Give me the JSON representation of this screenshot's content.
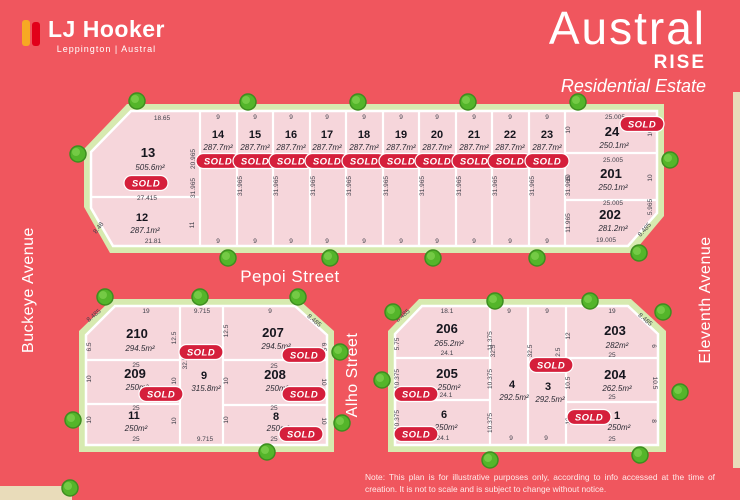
{
  "brand": {
    "name": "LJ Hooker",
    "location": "Leppington | Austral"
  },
  "title": {
    "main": "Austral",
    "sub": "RISE",
    "tagline": "Residential Estate"
  },
  "streets": {
    "buckeye": "Buckeye Avenue",
    "eleventh": "Eleventh Avenue",
    "pepoi": "Pepoi Street",
    "alho": "Alho Street"
  },
  "note": {
    "line1": "Note: This plan is for illustrative purposes only, according to info accessed at the time of",
    "line2": "creation. It is not to scale and is subject to change without notice."
  },
  "sold_label": "SOLD",
  "colors": {
    "background": "#f0565e",
    "lot_fill": "#f6d6db",
    "border_green": "#d7eab0",
    "tree_green": "#54b52a",
    "sold_red": "#d51f3b",
    "logo_yellow": "#f7a823",
    "logo_red": "#e2001a"
  },
  "lots": {
    "13": {
      "num": "13",
      "area": "505.6m²",
      "sold": true
    },
    "12": {
      "num": "12",
      "area": "287.1m²",
      "sold": false
    },
    "14": {
      "num": "14",
      "area": "287.7m²",
      "sold": true
    },
    "15": {
      "num": "15",
      "area": "287.7m²",
      "sold": true
    },
    "16": {
      "num": "16",
      "area": "287.7m²",
      "sold": true
    },
    "17": {
      "num": "17",
      "area": "287.7m²",
      "sold": true
    },
    "18": {
      "num": "18",
      "area": "287.7m²",
      "sold": true
    },
    "19": {
      "num": "19",
      "area": "287.7m²",
      "sold": true
    },
    "20": {
      "num": "20",
      "area": "287.7m²",
      "sold": true
    },
    "21": {
      "num": "21",
      "area": "287.7m²",
      "sold": true
    },
    "22": {
      "num": "22",
      "area": "287.7m²",
      "sold": true
    },
    "23": {
      "num": "23",
      "area": "287.7m²",
      "sold": true
    },
    "24": {
      "num": "24",
      "area": "250.1m²",
      "sold": true
    },
    "201": {
      "num": "201",
      "area": "250.1m²",
      "sold": false
    },
    "202": {
      "num": "202",
      "area": "281.2m²",
      "sold": false
    },
    "210": {
      "num": "210",
      "area": "294.5m²",
      "sold": false
    },
    "209": {
      "num": "209",
      "area": "250m²",
      "sold": true
    },
    "11": {
      "num": "11",
      "area": "250m²",
      "sold": false
    },
    "9": {
      "num": "9",
      "area": "315.8m²",
      "sold": true
    },
    "207": {
      "num": "207",
      "area": "294.5m²",
      "sold": true
    },
    "208": {
      "num": "208",
      "area": "250m²",
      "sold": true
    },
    "8": {
      "num": "8",
      "area": "250m²",
      "sold": true
    },
    "206": {
      "num": "206",
      "area": "265.2m²",
      "sold": false
    },
    "205": {
      "num": "205",
      "area": "250m²",
      "sold": true
    },
    "6": {
      "num": "6",
      "area": "250m²",
      "sold": true
    },
    "4": {
      "num": "4",
      "area": "292.5m²",
      "sold": false
    },
    "3": {
      "num": "3",
      "area": "292.5m²",
      "sold": true
    },
    "203": {
      "num": "203",
      "area": "282m²",
      "sold": false
    },
    "204": {
      "num": "204",
      "area": "262.5m²",
      "sold": false
    },
    "1": {
      "num": "1",
      "area": "250m²",
      "sold": true
    }
  },
  "dims": {
    "d6": "6",
    "d8": "8",
    "d9": "9",
    "d10": "10",
    "d11": "11",
    "d12": "12",
    "d19": "19",
    "d25": "25",
    "d65": "6.5",
    "d105": "10.5",
    "d125": "12.5",
    "d181": "18.1",
    "d241": "24.1",
    "d325": "32.5",
    "d575": "5.75",
    "d848": "8.48",
    "d8485": "8.485",
    "d2181": "21.81",
    "d1865": "18.65",
    "d5965": "5.965",
    "d9715": "9.715",
    "d10375": "10.375",
    "d11375": "11.375",
    "d11965": "11.965",
    "d19005": "19.005",
    "d20965": "20.965",
    "d25005": "25.005",
    "d27415": "27.415",
    "d31965": "31.965"
  }
}
